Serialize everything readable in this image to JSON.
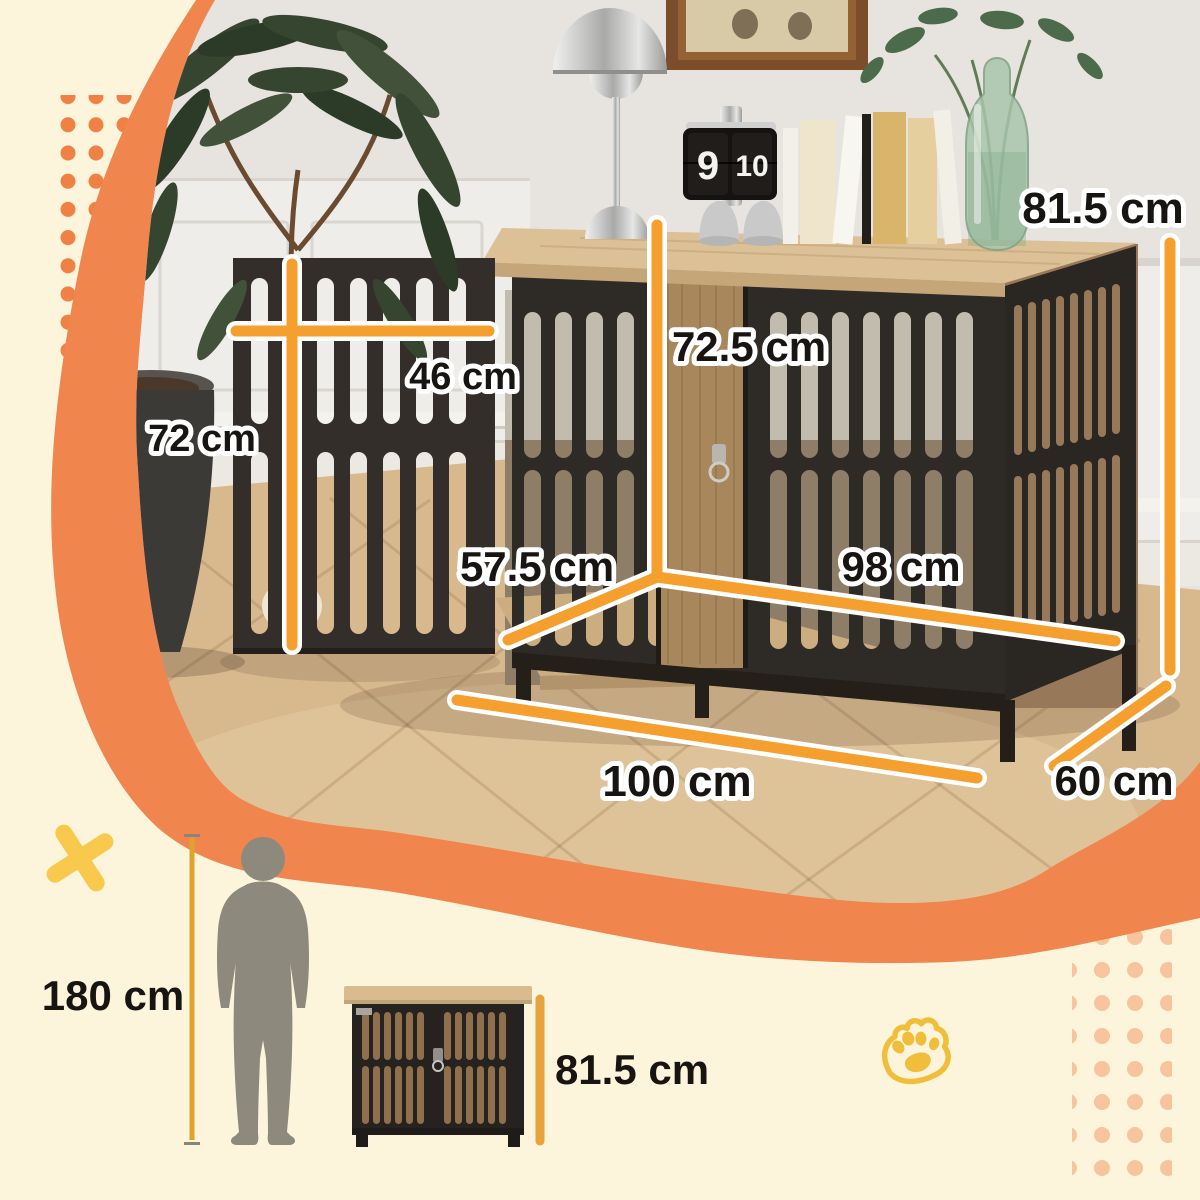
{
  "image_type": "product-dimensions-infographic",
  "dimensions": {
    "overall_height": "81.5 cm",
    "door_width": "46 cm",
    "door_height": "72 cm",
    "interior_height": "72.5 cm",
    "interior_depth": "57.5 cm",
    "interior_width": "98 cm",
    "overall_width": "100 cm",
    "overall_depth": "60 cm"
  },
  "scale_comparison": {
    "person_height": "180 cm",
    "product_height": "81.5 cm"
  },
  "photo": {
    "flip_clock": {
      "hour": "9",
      "minute": "10"
    }
  },
  "icons": {
    "x_mark": "x-mark-icon",
    "paw": "paw-print-icon",
    "dots_top_left": "dot-grid-pattern",
    "dots_bottom_right": "dot-grid-pattern"
  },
  "colors": {
    "background": "#FCF5DB",
    "blob_orange": "#F0854E",
    "dimension_line": "#F5A02E",
    "label_text": "#171411",
    "accent_yellow": "#F8C94D",
    "silhouette_gray": "#8D897C"
  }
}
